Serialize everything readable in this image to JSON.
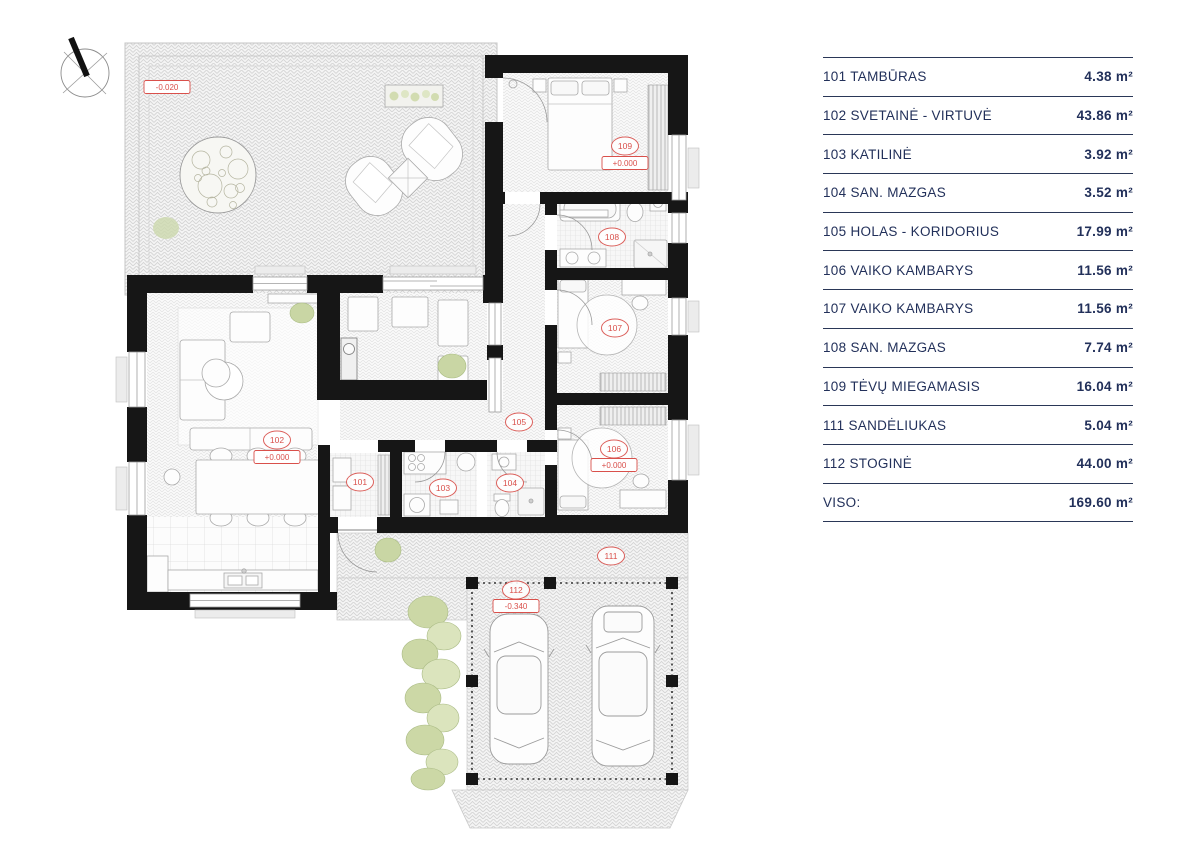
{
  "legend": {
    "rows": [
      {
        "label": "101 TAMBŪRAS",
        "area": "4.38 m²"
      },
      {
        "label": "102 SVETAINĖ - VIRTUVĖ",
        "area": "43.86 m²"
      },
      {
        "label": "103 KATILINĖ",
        "area": "3.92 m²"
      },
      {
        "label": "104 SAN. MAZGAS",
        "area": "3.52 m²"
      },
      {
        "label": "105 HOLAS - KORIDORIUS",
        "area": "17.99 m²"
      },
      {
        "label": "106 VAIKO KAMBARYS",
        "area": "11.56 m²"
      },
      {
        "label": "107 VAIKO KAMBARYS",
        "area": "11.56 m²"
      },
      {
        "label": "108 SAN. MAZGAS",
        "area": "7.74 m²"
      },
      {
        "label": "109 TĖVŲ MIEGAMASIS",
        "area": "16.04 m²"
      },
      {
        "label": "111 SANDĖLIUKAS",
        "area": "5.04 m²"
      },
      {
        "label": "112 STOGINĖ",
        "area": "44.00 m²"
      },
      {
        "label": "VISO:",
        "area": "169.60 m²"
      }
    ]
  },
  "plan": {
    "rooms": [
      "101",
      "102",
      "103",
      "104",
      "105",
      "106",
      "107",
      "108",
      "109",
      "111",
      "112"
    ],
    "levels": [
      "-0.020",
      "+0.000",
      "+0.000",
      "+0.000",
      "-0.340"
    ],
    "colors": {
      "label_red": "#d9504b",
      "legend_navy": "#22305a",
      "wall_black": "#161616",
      "greenery": "#c9d6a4"
    }
  }
}
